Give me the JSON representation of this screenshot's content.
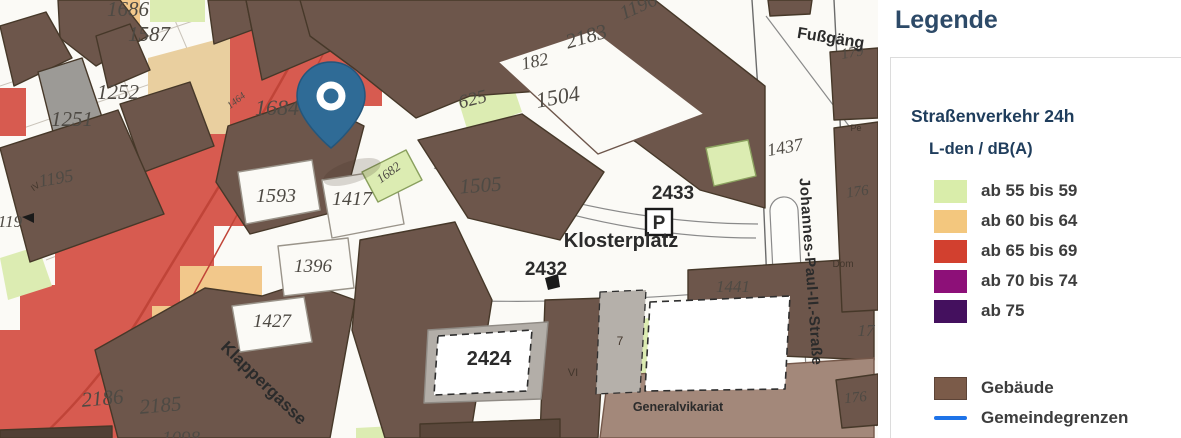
{
  "legend": {
    "title": "Legende",
    "section_title": "Straßenverkehr 24h",
    "subtitle": "L-den / dB(A)",
    "classes": [
      {
        "label": "ab 55 bis 59",
        "color": "#d9edaa"
      },
      {
        "label": "ab 60 bis 64",
        "color": "#f3c77e"
      },
      {
        "label": "ab 65 bis 69",
        "color": "#d2402f"
      },
      {
        "label": "ab 70 bis 74",
        "color": "#8d1078"
      },
      {
        "label": "ab 75",
        "color": "#44105e"
      }
    ],
    "other": [
      {
        "label": "Gebäude",
        "color": "#7b5b49",
        "type": "swatch"
      },
      {
        "label": "Gemeindegrenzen",
        "color": "#1e73e8",
        "type": "line"
      }
    ]
  },
  "map": {
    "parking_label": "P",
    "streets": {
      "johannes_paul": "Johannes-Paul-II.-Straße",
      "klappergasse": "Klappergasse",
      "fussgaengerzone": "Fußgäng"
    },
    "places": {
      "klosterplatz": "Klosterplatz",
      "generalvikariat": "Generalvikariat"
    },
    "parcel_labels": [
      "1686",
      "1587",
      "1252",
      "1251",
      "1195",
      "119",
      "1684",
      "1593",
      "1417",
      "1682",
      "625",
      "182",
      "1504",
      "2183",
      "1196",
      "1505",
      "1396",
      "1427",
      "2186",
      "2185",
      "1098",
      "2433",
      "2432",
      "2424",
      "1441",
      "1437",
      "179",
      "176",
      "17",
      "176",
      "1464"
    ],
    "small_labels": [
      "VI",
      "7",
      "IV",
      "Pe",
      "Dom"
    ],
    "colors": {
      "noise_red_band": "#d75b50",
      "noise_orange_band": "#f2c88b",
      "noise_tan": "#e9cf9f",
      "noise_green": "#dcecb2",
      "building_brown": "#6d564b",
      "building_light_brown": "#a3887a",
      "building_gray": "#9c9a96",
      "pin_blue": "#2f6b96"
    }
  }
}
